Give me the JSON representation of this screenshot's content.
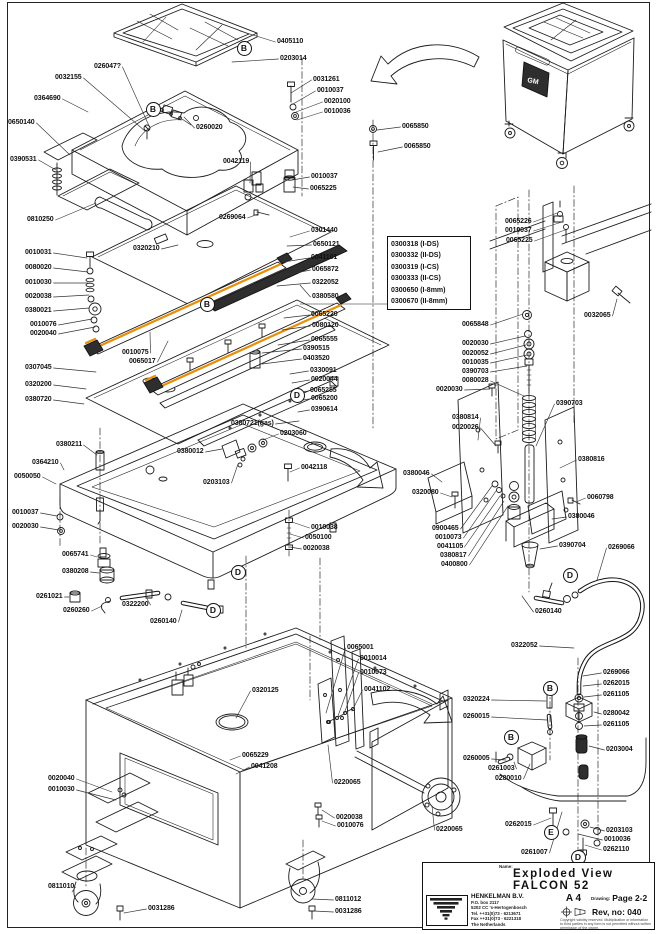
{
  "diagram": {
    "accent_color": "#E8900A",
    "machine_badge": "GM",
    "options": [
      "0300318 (I-DS)",
      "0300332 (II-DS)",
      "0300319 (I-CS)",
      "0300333 (II-CS)",
      "0300650 (I-8mm)",
      "0300670 (II-8mm)"
    ],
    "labels": [
      [
        "0405110",
        277,
        42,
        240,
        31
      ],
      [
        "0203014",
        280,
        59,
        232,
        62
      ],
      [
        "026047?",
        94,
        67,
        150,
        128
      ],
      [
        "0032155",
        55,
        78,
        145,
        131
      ],
      [
        "0364690",
        34,
        99,
        88,
        112
      ],
      [
        "0031261",
        313,
        80,
        291,
        93
      ],
      [
        "0010037",
        317,
        91,
        293,
        104
      ],
      [
        "0020100",
        324,
        102,
        296,
        112
      ],
      [
        "0010036",
        324,
        112,
        297,
        120
      ],
      [
        "0650140",
        8,
        123,
        70,
        155
      ],
      [
        "0260020",
        196,
        128,
        184,
        117
      ],
      [
        "0065850",
        402,
        127,
        377,
        130
      ],
      [
        "0065850",
        404,
        147,
        378,
        152
      ],
      [
        "0390531",
        10,
        160,
        56,
        170
      ],
      [
        "0042119",
        223,
        162,
        250,
        183
      ],
      [
        "0010037",
        311,
        177,
        292,
        180
      ],
      [
        "0065225",
        310,
        189,
        293,
        187
      ],
      [
        "0810250",
        27,
        220,
        96,
        203
      ],
      [
        "0269064",
        219,
        218,
        258,
        214
      ],
      [
        "0301440",
        311,
        231,
        290,
        237
      ],
      [
        "0650121",
        313,
        245,
        287,
        246
      ],
      [
        "0320210",
        133,
        249,
        178,
        245
      ],
      [
        "0041101",
        311,
        258,
        283,
        262
      ],
      [
        "0065872",
        312,
        270,
        280,
        276
      ],
      [
        "0322052",
        312,
        283,
        277,
        286
      ],
      [
        "0380580",
        312,
        297,
        300,
        285
      ],
      [
        "0065220",
        311,
        315,
        284,
        318
      ],
      [
        "0080120",
        312,
        326,
        282,
        330
      ],
      [
        "0065555",
        311,
        340,
        278,
        345
      ],
      [
        "0390515",
        303,
        349,
        262,
        353
      ],
      [
        "0403520",
        303,
        359,
        262,
        364
      ],
      [
        "0330091",
        310,
        371,
        290,
        374
      ],
      [
        "0020044",
        311,
        380,
        292,
        383
      ],
      [
        "0065255",
        310,
        391,
        296,
        393
      ],
      [
        "0065200",
        311,
        399,
        297,
        401
      ],
      [
        "0390614",
        311,
        410,
        298,
        412
      ],
      [
        "0010031",
        25,
        253,
        87,
        258
      ],
      [
        "0080020",
        25,
        268,
        88,
        272
      ],
      [
        "0010030",
        25,
        283,
        88,
        283
      ],
      [
        "0020038",
        25,
        297,
        89,
        295
      ],
      [
        "0380021",
        25,
        311,
        89,
        308
      ],
      [
        "0010076",
        30,
        325,
        92,
        319
      ],
      [
        "0020040",
        30,
        334,
        95,
        327
      ],
      [
        "0010075",
        122,
        353,
        150,
        332
      ],
      [
        "0065017",
        129,
        362,
        168,
        341
      ],
      [
        "0307045",
        25,
        368,
        96,
        372
      ],
      [
        "0320200",
        25,
        385,
        86,
        389
      ],
      [
        "0380720",
        25,
        400,
        84,
        404
      ],
      [
        "0380211",
        56,
        445,
        97,
        455
      ],
      [
        "0380721(gas)",
        231,
        424,
        299,
        421
      ],
      [
        "0203060",
        280,
        434,
        263,
        440
      ],
      [
        "0380012",
        177,
        452,
        222,
        449
      ],
      [
        "0203103",
        203,
        483,
        238,
        464
      ],
      [
        "0042118",
        301,
        468,
        290,
        472
      ],
      [
        "0364210",
        32,
        463,
        64,
        470
      ],
      [
        "0050050",
        14,
        477,
        56,
        484
      ],
      [
        "0010037",
        12,
        513,
        57,
        516
      ],
      [
        "0020030",
        12,
        527,
        59,
        530
      ],
      [
        "0065741",
        62,
        555,
        97,
        557
      ],
      [
        "0380208",
        62,
        572,
        99,
        573
      ],
      [
        "0261021",
        36,
        597,
        69,
        597
      ],
      [
        "0260260",
        63,
        611,
        102,
        606
      ],
      [
        "0322200",
        122,
        605,
        146,
        597
      ],
      [
        "0260140",
        150,
        622,
        182,
        610
      ],
      [
        "0010038",
        311,
        528,
        292,
        522
      ],
      [
        "0050100",
        305,
        538,
        290,
        534
      ],
      [
        "0020038",
        303,
        549,
        290,
        547
      ],
      [
        "0065226",
        505,
        222,
        557,
        213
      ],
      [
        "0010037",
        505,
        231,
        562,
        222
      ],
      [
        "0065225",
        506,
        241,
        565,
        230
      ],
      [
        "0032065",
        584,
        316,
        617,
        299
      ],
      [
        "0065848",
        462,
        325,
        523,
        314
      ],
      [
        "0020030",
        462,
        344,
        525,
        336
      ],
      [
        "0020052",
        462,
        354,
        526,
        345
      ],
      [
        "0010035",
        462,
        363,
        527,
        355
      ],
      [
        "0390703",
        462,
        372,
        527,
        366
      ],
      [
        "0080028",
        462,
        381,
        524,
        396
      ],
      [
        "0020030",
        436,
        390,
        490,
        389
      ],
      [
        "0380814",
        452,
        418,
        478,
        440
      ],
      [
        "0020026",
        452,
        428,
        496,
        446
      ],
      [
        "0390703",
        556,
        404,
        536,
        446
      ],
      [
        "0380816",
        578,
        460,
        560,
        468
      ],
      [
        "0380046",
        403,
        474,
        442,
        482
      ],
      [
        "0320080",
        412,
        493,
        452,
        497
      ],
      [
        "0060798",
        587,
        498,
        576,
        502
      ],
      [
        "0380046",
        568,
        517,
        552,
        519
      ],
      [
        "0900465",
        432,
        529,
        492,
        486
      ],
      [
        "0010073",
        435,
        538,
        496,
        491
      ],
      [
        "0041105",
        437,
        547,
        500,
        496
      ],
      [
        "0380817",
        440,
        556,
        504,
        501
      ],
      [
        "0400800",
        441,
        565,
        508,
        506
      ],
      [
        "0390704",
        559,
        546,
        540,
        549
      ],
      [
        "0269066",
        608,
        548,
        597,
        580
      ],
      [
        "0260140",
        535,
        612,
        522,
        596
      ],
      [
        "0322052",
        511,
        646,
        574,
        648
      ],
      [
        "0269066",
        603,
        673,
        583,
        676
      ],
      [
        "0262015",
        603,
        684,
        583,
        686
      ],
      [
        "0261105",
        603,
        695,
        584,
        697
      ],
      [
        "0280042",
        603,
        714,
        594,
        712
      ],
      [
        "0261105",
        603,
        725,
        584,
        726
      ],
      [
        "0203004",
        606,
        750,
        589,
        746
      ],
      [
        "0262015",
        505,
        825,
        551,
        818
      ],
      [
        "0203103",
        606,
        831,
        590,
        827
      ],
      [
        "0010036",
        604,
        840,
        578,
        834
      ],
      [
        "0262110",
        603,
        850,
        585,
        845
      ],
      [
        "0261007",
        521,
        853,
        562,
        812
      ],
      [
        "0320224",
        463,
        700,
        546,
        701
      ],
      [
        "0260015",
        463,
        717,
        547,
        720
      ],
      [
        "0260005",
        463,
        759,
        506,
        760
      ],
      [
        "0261003",
        488,
        769,
        514,
        762
      ],
      [
        "0280010",
        495,
        779,
        530,
        764
      ],
      [
        "0065001",
        347,
        648,
        326,
        713
      ],
      [
        "0010014",
        360,
        659,
        338,
        716
      ],
      [
        "0010073",
        360,
        673,
        344,
        714
      ],
      [
        "0041102",
        364,
        690,
        352,
        711
      ],
      [
        "0220065",
        334,
        783,
        328,
        745
      ],
      [
        "0020038",
        336,
        818,
        322,
        810
      ],
      [
        "0010076",
        337,
        826,
        322,
        821
      ],
      [
        "0220065",
        436,
        830,
        432,
        806
      ],
      [
        "0320125",
        252,
        691,
        236,
        718
      ],
      [
        "0065229",
        242,
        756,
        230,
        760
      ],
      [
        "0041208",
        251,
        767,
        236,
        774
      ],
      [
        "0020040",
        48,
        779,
        112,
        792
      ],
      [
        "0010030",
        48,
        790,
        116,
        800
      ],
      [
        "0811010",
        48,
        887,
        72,
        892
      ],
      [
        "0031286",
        148,
        909,
        124,
        913
      ],
      [
        "0811012",
        335,
        900,
        312,
        899
      ],
      [
        "0031286",
        335,
        912,
        314,
        911
      ]
    ],
    "letters": [
      [
        "B",
        243,
        47
      ],
      [
        "B",
        152,
        108
      ],
      [
        "B",
        206,
        303
      ],
      [
        "D",
        296,
        394
      ],
      [
        "D",
        237,
        571
      ],
      [
        "D",
        212,
        609
      ],
      [
        "D",
        569,
        574
      ],
      [
        "B",
        549,
        687
      ],
      [
        "B",
        510,
        736
      ],
      [
        "E",
        550,
        831
      ],
      [
        "D",
        577,
        856
      ]
    ]
  },
  "title_block": {
    "scale_label": "Scale:",
    "date_label": "Date:",
    "date": "March 2007",
    "drawn_label": "Drawn by:",
    "drawn": "MD",
    "name_label": "Name:",
    "name_line1": "Exploded View",
    "name_line2": "FALCON 52",
    "company": "HENKELMAN B.V.",
    "address": [
      "P.O. box 2117",
      "5202 CC 's-Hertogenbosch",
      "Tel. ++31(0)73 - 6213671",
      "Fax ++31(0)73 - 6221318",
      "The Netherlands"
    ],
    "paper_size": "A 4",
    "drawing_label": "Drawing:",
    "page": "Page 2-2",
    "rev": "Rev, no: 040",
    "fine_print": "Copyright validity reserved. Multiplication or information to third parties in any form is not permitted without written permission of the owner."
  }
}
